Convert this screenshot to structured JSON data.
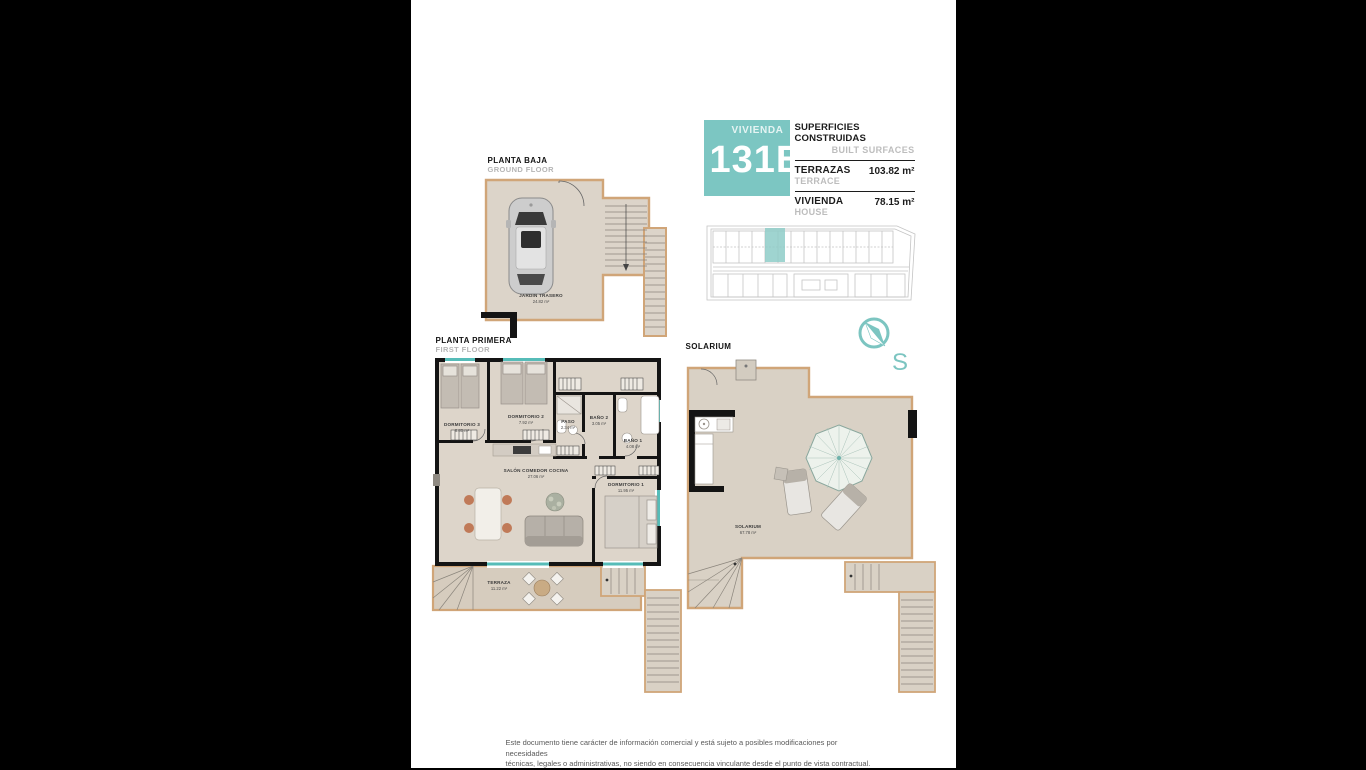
{
  "unit": {
    "word": "VIVIENDA",
    "number": "131B"
  },
  "surfaces": {
    "title_es": "SUPERFICIES CONSTRUIDAS",
    "title_en": "BUILT SURFACES",
    "rows": [
      {
        "label_es": "TERRAZAS",
        "label_en": "TERRACE",
        "value": "103.82 m²"
      },
      {
        "label_es": "VIVIENDA",
        "label_en": "HOUSE",
        "value": "78.15 m²"
      }
    ]
  },
  "compass": {
    "south_label": "S"
  },
  "plans": {
    "ground": {
      "title": "PLANTA BAJA",
      "subtitle": "GROUND FLOOR",
      "rooms": {
        "jardin": {
          "name": "JARDIN TRASERO",
          "area": "24.82 m²"
        }
      }
    },
    "first": {
      "title": "PLANTA PRIMERA",
      "subtitle": "FIRST FLOOR",
      "rooms": {
        "dorm3": {
          "name": "DORMITORIO 3",
          "area": "8.80 m²"
        },
        "dorm2": {
          "name": "DORMITORIO 2",
          "area": "7.92 m²"
        },
        "paso": {
          "name": "PASO",
          "area": "2.34 m²"
        },
        "bano2": {
          "name": "BAÑO 2",
          "area": "3.05 m²"
        },
        "bano1": {
          "name": "BAÑO 1",
          "area": "4.08 m²"
        },
        "salon": {
          "name": "SALÓN COMEDOR COCINA",
          "area": "27.06 m²"
        },
        "dorm1": {
          "name": "DORMITORIO 1",
          "area": "11.95 m²"
        },
        "terraza": {
          "name": "TERRAZA",
          "area": "11.22 m²"
        }
      }
    },
    "solarium": {
      "title": "SOLARIUM",
      "rooms": {
        "solarium": {
          "name": "SOLARIUM",
          "area": "67.78 m²"
        }
      }
    }
  },
  "footer": {
    "line1": "Este documento tiene carácter de información comercial y está sujeto a posibles modificaciones por necesidades",
    "line2": "técnicas, legales o administrativas, no siendo en consecuencia vinculante desde el punto de vista contractual."
  }
}
